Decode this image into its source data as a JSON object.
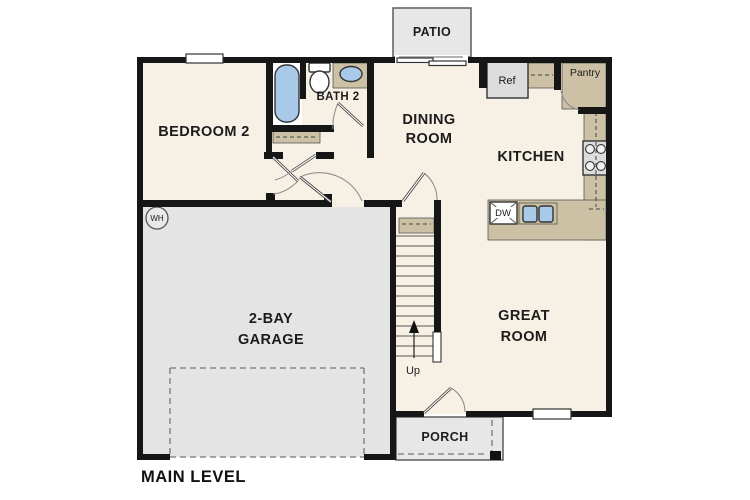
{
  "plan": {
    "level_label": "MAIN LEVEL",
    "rooms": {
      "bedroom2": {
        "label": "BEDROOM 2"
      },
      "bath2": {
        "label": "BATH 2"
      },
      "dining": {
        "line1": "DINING",
        "line2": "ROOM"
      },
      "kitchen": {
        "label": "KITCHEN"
      },
      "great_room": {
        "line1": "GREAT",
        "line2": "ROOM"
      },
      "garage": {
        "line1": "2-BAY",
        "line2": "GARAGE"
      },
      "patio": {
        "label": "PATIO"
      },
      "porch": {
        "label": "PORCH"
      },
      "pantry": {
        "label": "Pantry"
      }
    },
    "fixtures": {
      "refrigerator": "Ref",
      "dishwasher": "DW",
      "water_heater": "WH",
      "stairs_direction": "Up"
    },
    "colors": {
      "wall": "#161616",
      "floor": "#f7f0e4",
      "garage_floor": "#e4e4e4",
      "outdoor": "#e7e7e7",
      "counter": "#cdc1a5",
      "fixture_blue": "#a9c9e9",
      "appliance_grey": "#dcdcdc"
    }
  }
}
